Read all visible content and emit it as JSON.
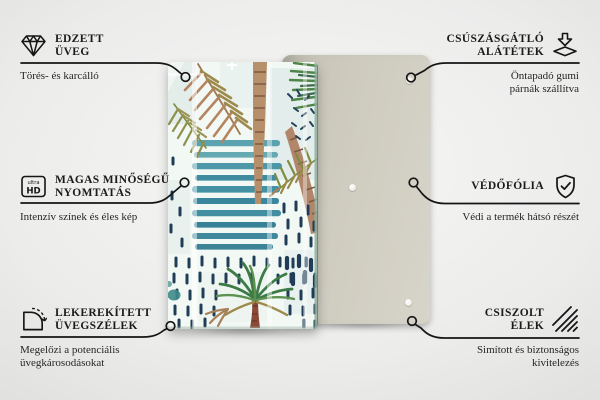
{
  "features": {
    "left": [
      {
        "id": "tempered-glass",
        "icon": "diamond-icon",
        "title_lines": [
          "EDZETT",
          "ÜVEG"
        ],
        "subtitle_lines": [
          "Törés- és karcálló"
        ]
      },
      {
        "id": "high-quality-print",
        "icon": "ultra-hd-icon",
        "icon_text": [
          "ultra",
          "HD"
        ],
        "title_lines": [
          "MAGAS MINŐSÉGŰ",
          "NYOMTATÁS"
        ],
        "subtitle_lines": [
          "Intenzív színek és éles kép"
        ]
      },
      {
        "id": "rounded-glass-edges",
        "icon": "rounded-corner-icon",
        "title_lines": [
          "LEKEREKÍTETT",
          "ÜVEGSZÉLEK"
        ],
        "subtitle_lines": [
          "Megelőzi a potenciális",
          "üvegkárosodásokat"
        ]
      }
    ],
    "right": [
      {
        "id": "anti-slip-pads",
        "icon": "anti-slip-pad-icon",
        "title_lines": [
          "CSÚSZÁSGÁTLÓ",
          "ALÁTÉTEK"
        ],
        "subtitle_lines": [
          "Öntapadó gumi",
          "párnák szállítva"
        ]
      },
      {
        "id": "protective-film",
        "icon": "shield-check-icon",
        "title_lines": [
          "VÉDŐFÓLIA"
        ],
        "subtitle_lines": [
          "Védi a termék hátsó részét"
        ]
      },
      {
        "id": "polished-edges",
        "icon": "polished-edge-icon",
        "title_lines": [
          "CSISZOLT",
          "ÉLEK"
        ],
        "subtitle_lines": [
          "Simított és biztonságos",
          "kivitelezés"
        ]
      }
    ]
  },
  "product": {
    "description": "Tropical watercolor print glass board shown upright, with beige back panel and rubber pads behind it",
    "artwork_elements": [
      "tan palm frond",
      "olive palm frond",
      "two palm trunks",
      "green palm leaves",
      "teal watercolor stripes",
      "navy dash pattern",
      "watercolor palm tree"
    ],
    "colors": {
      "back_panel": "#cfccc0",
      "artwork_background": "#f2f8f3",
      "stripe_teal": "#3d8da1",
      "navy_dots": "#203d57",
      "frond_tan": "#b5855f",
      "frond_olive": "#8f9050",
      "leaf_green": "#4f8448",
      "trunk_brown": "#b78f6b"
    }
  },
  "canvas": {
    "line_color": "#151515",
    "text_color": "#1b1b1b",
    "background": "#ececeb"
  }
}
